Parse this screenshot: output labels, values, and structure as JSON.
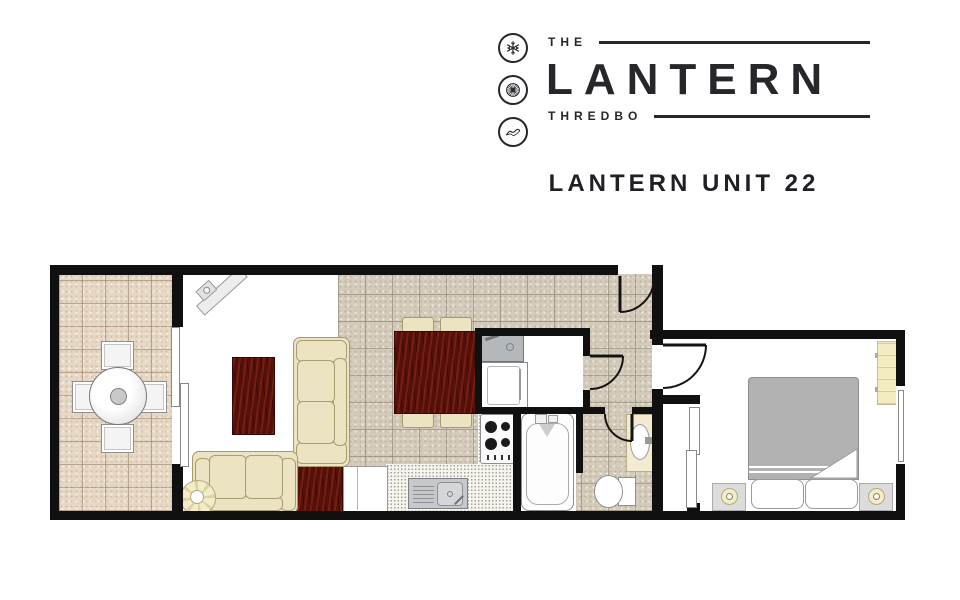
{
  "header": {
    "logo": {
      "word_top": "THE",
      "word_main": "LANTERN",
      "word_bottom": "THREDBO",
      "icons": [
        "snowflake-icon",
        "wagon-wheel-icon",
        "mountains-icon"
      ],
      "ink_color": "#26262b"
    },
    "title": "LANTERN UNIT 22"
  },
  "colors": {
    "wall": "#101010",
    "balcony_tile": "#e6d8c4",
    "kitchen_tile": "#d4cbba",
    "cream_furniture": "#ece3c2",
    "dark_wood": "#570f0a",
    "bed_gray": "#b2b2b2",
    "lamp_cream": "#f3ecca",
    "counter_stipple": "#f6f4ef"
  },
  "floorplan": {
    "rooms": [
      "balcony",
      "living-room",
      "kitchen-dining",
      "kitchenette-nook",
      "bathroom",
      "wc-vanity",
      "hallway",
      "bedroom"
    ],
    "furniture": [
      "outdoor-round-table",
      "outdoor-chairs-x4",
      "corner-tv",
      "coffee-table",
      "sofa-3-seat",
      "sofa-2-seat",
      "round-side-table",
      "side-table",
      "dining-table",
      "dining-chairs-x4",
      "kitchenette-sink",
      "fridge",
      "cooktop-4-burner",
      "kitchen-sink",
      "kitchen-cabinet",
      "bathtub-with-shower",
      "toilet",
      "vanity-basin",
      "double-bed",
      "pillows-x2",
      "nightstands-with-lamps-x2",
      "wardrobe-shelf",
      "sliding-balcony-door",
      "sliding-wardrobe-doors",
      "entry-door",
      "bedroom-door",
      "wc-door",
      "kitchenette-door",
      "bedroom-window"
    ]
  }
}
